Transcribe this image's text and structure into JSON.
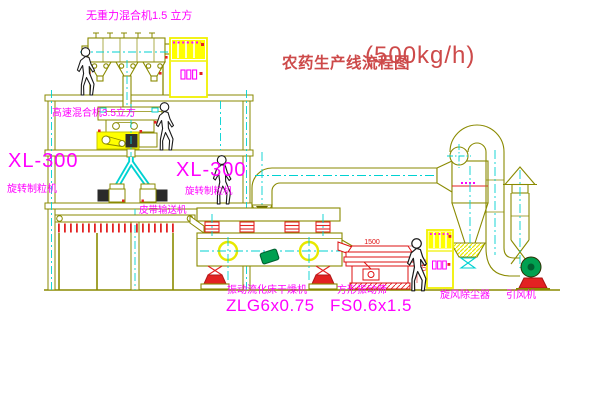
{
  "title": {
    "name": "农药生产线流程图",
    "capacity": "(500kg/h)"
  },
  "labels": {
    "gravity_mixer": "无重力混合机1.5 立方",
    "high_speed_mixer": "高速混合机3.5立方",
    "granulator_model_left": "XL-300",
    "granulator_name_left": "旋转制粒机",
    "granulator_model_right": "XL-300",
    "granulator_name_right": "旋转制粒机",
    "belt_conveyor": "皮带输送机",
    "dryer_name": "振动流化床干燥机",
    "dryer_model": "ZLG6x0.75",
    "screen_name": "方形振动筛",
    "screen_model": "FS0.6x1.5",
    "cyclone": "旋风除尘器",
    "fan": "引风机"
  },
  "dimensions": {
    "screen_length": "1500",
    "screen_height": "340"
  },
  "colors": {
    "line_olive": "#8a8a00",
    "centerline_cyan": "#00d2d2",
    "label_magenta": "#ff00ff",
    "accent_red": "#e32222",
    "cabinet_yellow": "#ffff00",
    "motor_green": "#00a050",
    "title_red": "#cd4a4a"
  }
}
